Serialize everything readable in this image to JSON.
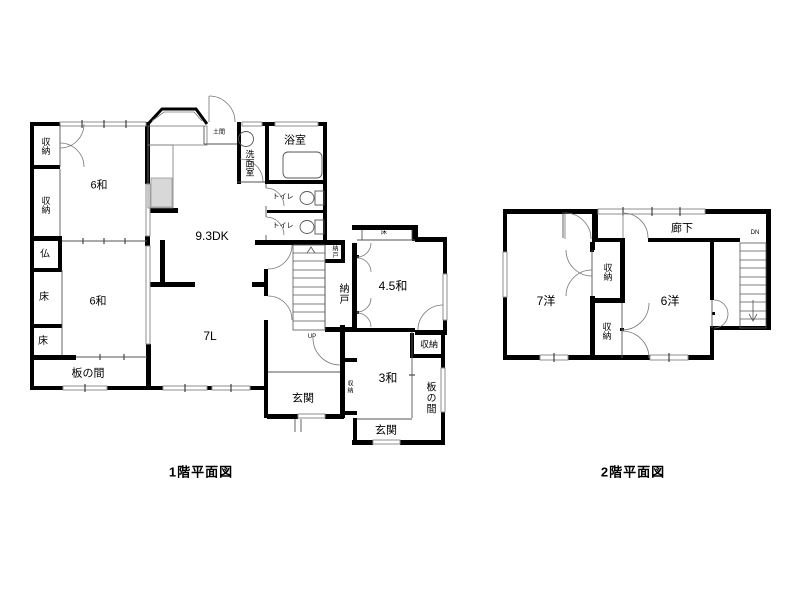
{
  "colors": {
    "wall": "#000000",
    "thin_line": "#555555",
    "window_line": "#8f8f8f",
    "door_arc": "#777777",
    "sink_fill": "#d8d8d8",
    "background": "#ffffff"
  },
  "floor1": {
    "title": "1階平面図",
    "labels": {
      "storage_top1": "収納",
      "storage_top2": "収納",
      "room6_upper": "6和",
      "butsudan": "仏",
      "toko1": "床",
      "room6_lower": "6和",
      "toko2": "床",
      "itanoma_left": "板の間",
      "dk": "9.3DK",
      "living": "7L",
      "doma": "土間",
      "washroom": "洗面室",
      "bath": "浴室",
      "toilet1": "トイレ",
      "toilet2": "トイレ",
      "nando_small": "納戸",
      "nando": "納戸",
      "room45": "4.5和",
      "toko3": "床",
      "storage_right": "収納",
      "itanoma_right": "板の間",
      "room3": "3和",
      "storage_tiny": "収納",
      "genkan_main": "玄関",
      "genkan2": "玄関",
      "up": "UP"
    }
  },
  "floor2": {
    "title": "2階平面図",
    "labels": {
      "corridor": "廊下",
      "room7y": "7洋",
      "storage_upper": "収納",
      "storage_lower": "収納",
      "room6y": "6洋",
      "dn": "DN"
    }
  }
}
